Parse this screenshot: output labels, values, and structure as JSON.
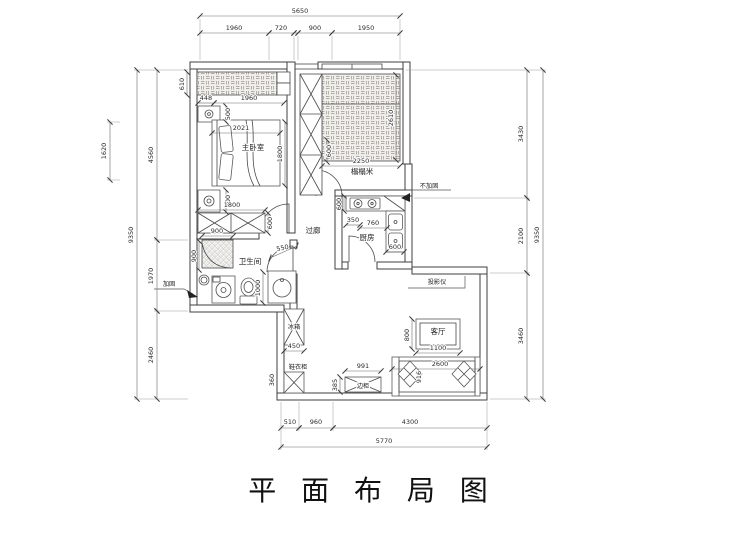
{
  "title": "平 面 布 局 图",
  "rooms": {
    "bedroom": "主卧室",
    "tatami": "榻榻米",
    "corridor": "过廊",
    "kitchen": "厨房",
    "bathroom": "卫生间",
    "living": "客厅",
    "fridge": "冰箱",
    "side_cabinet": "边柜",
    "shoe_cabinet": "鞋衣柜"
  },
  "annotations": {
    "reinforce": "加固",
    "no_reinforce": "不加固",
    "projector": "投影仪"
  },
  "dims": {
    "top_total": "5650",
    "top_1": "1960",
    "top_2": "720",
    "top_3": "900",
    "top_4": "1950",
    "left_total": "9350",
    "left_1": "4560",
    "left_2": "1970",
    "left_3": "2460",
    "left_aux": "1620",
    "right_total": "9350",
    "right_1": "3430",
    "right_2": "2100",
    "right_3": "3460",
    "bottom_total": "5770",
    "bottom_1": "510",
    "bottom_2": "960",
    "bottom_3": "4300",
    "bed_610": "610",
    "bed_448": "448",
    "bed_1960": "1960",
    "bed_500_top": "500",
    "bed_2021": "2021",
    "bed_1800": "1800",
    "bed_500_bottom": "500",
    "ward_1800": "1800",
    "ward_600": "600",
    "col_600": "600",
    "tatami_2250": "2250",
    "tatami_2610": "2610",
    "kit_600_left": "600",
    "kit_350": "350",
    "kit_760": "760",
    "kit_600_right": "600",
    "bath_900_top": "900",
    "bath_900_left": "900",
    "bath_550": "550",
    "bath_1000": "1000",
    "fridge_450": "450",
    "shoe_360": "360",
    "table_800": "800",
    "table_1100": "1100",
    "sofa_2600": "2600",
    "sofa_916": "916",
    "cab_991": "991",
    "cab_385": "385"
  }
}
